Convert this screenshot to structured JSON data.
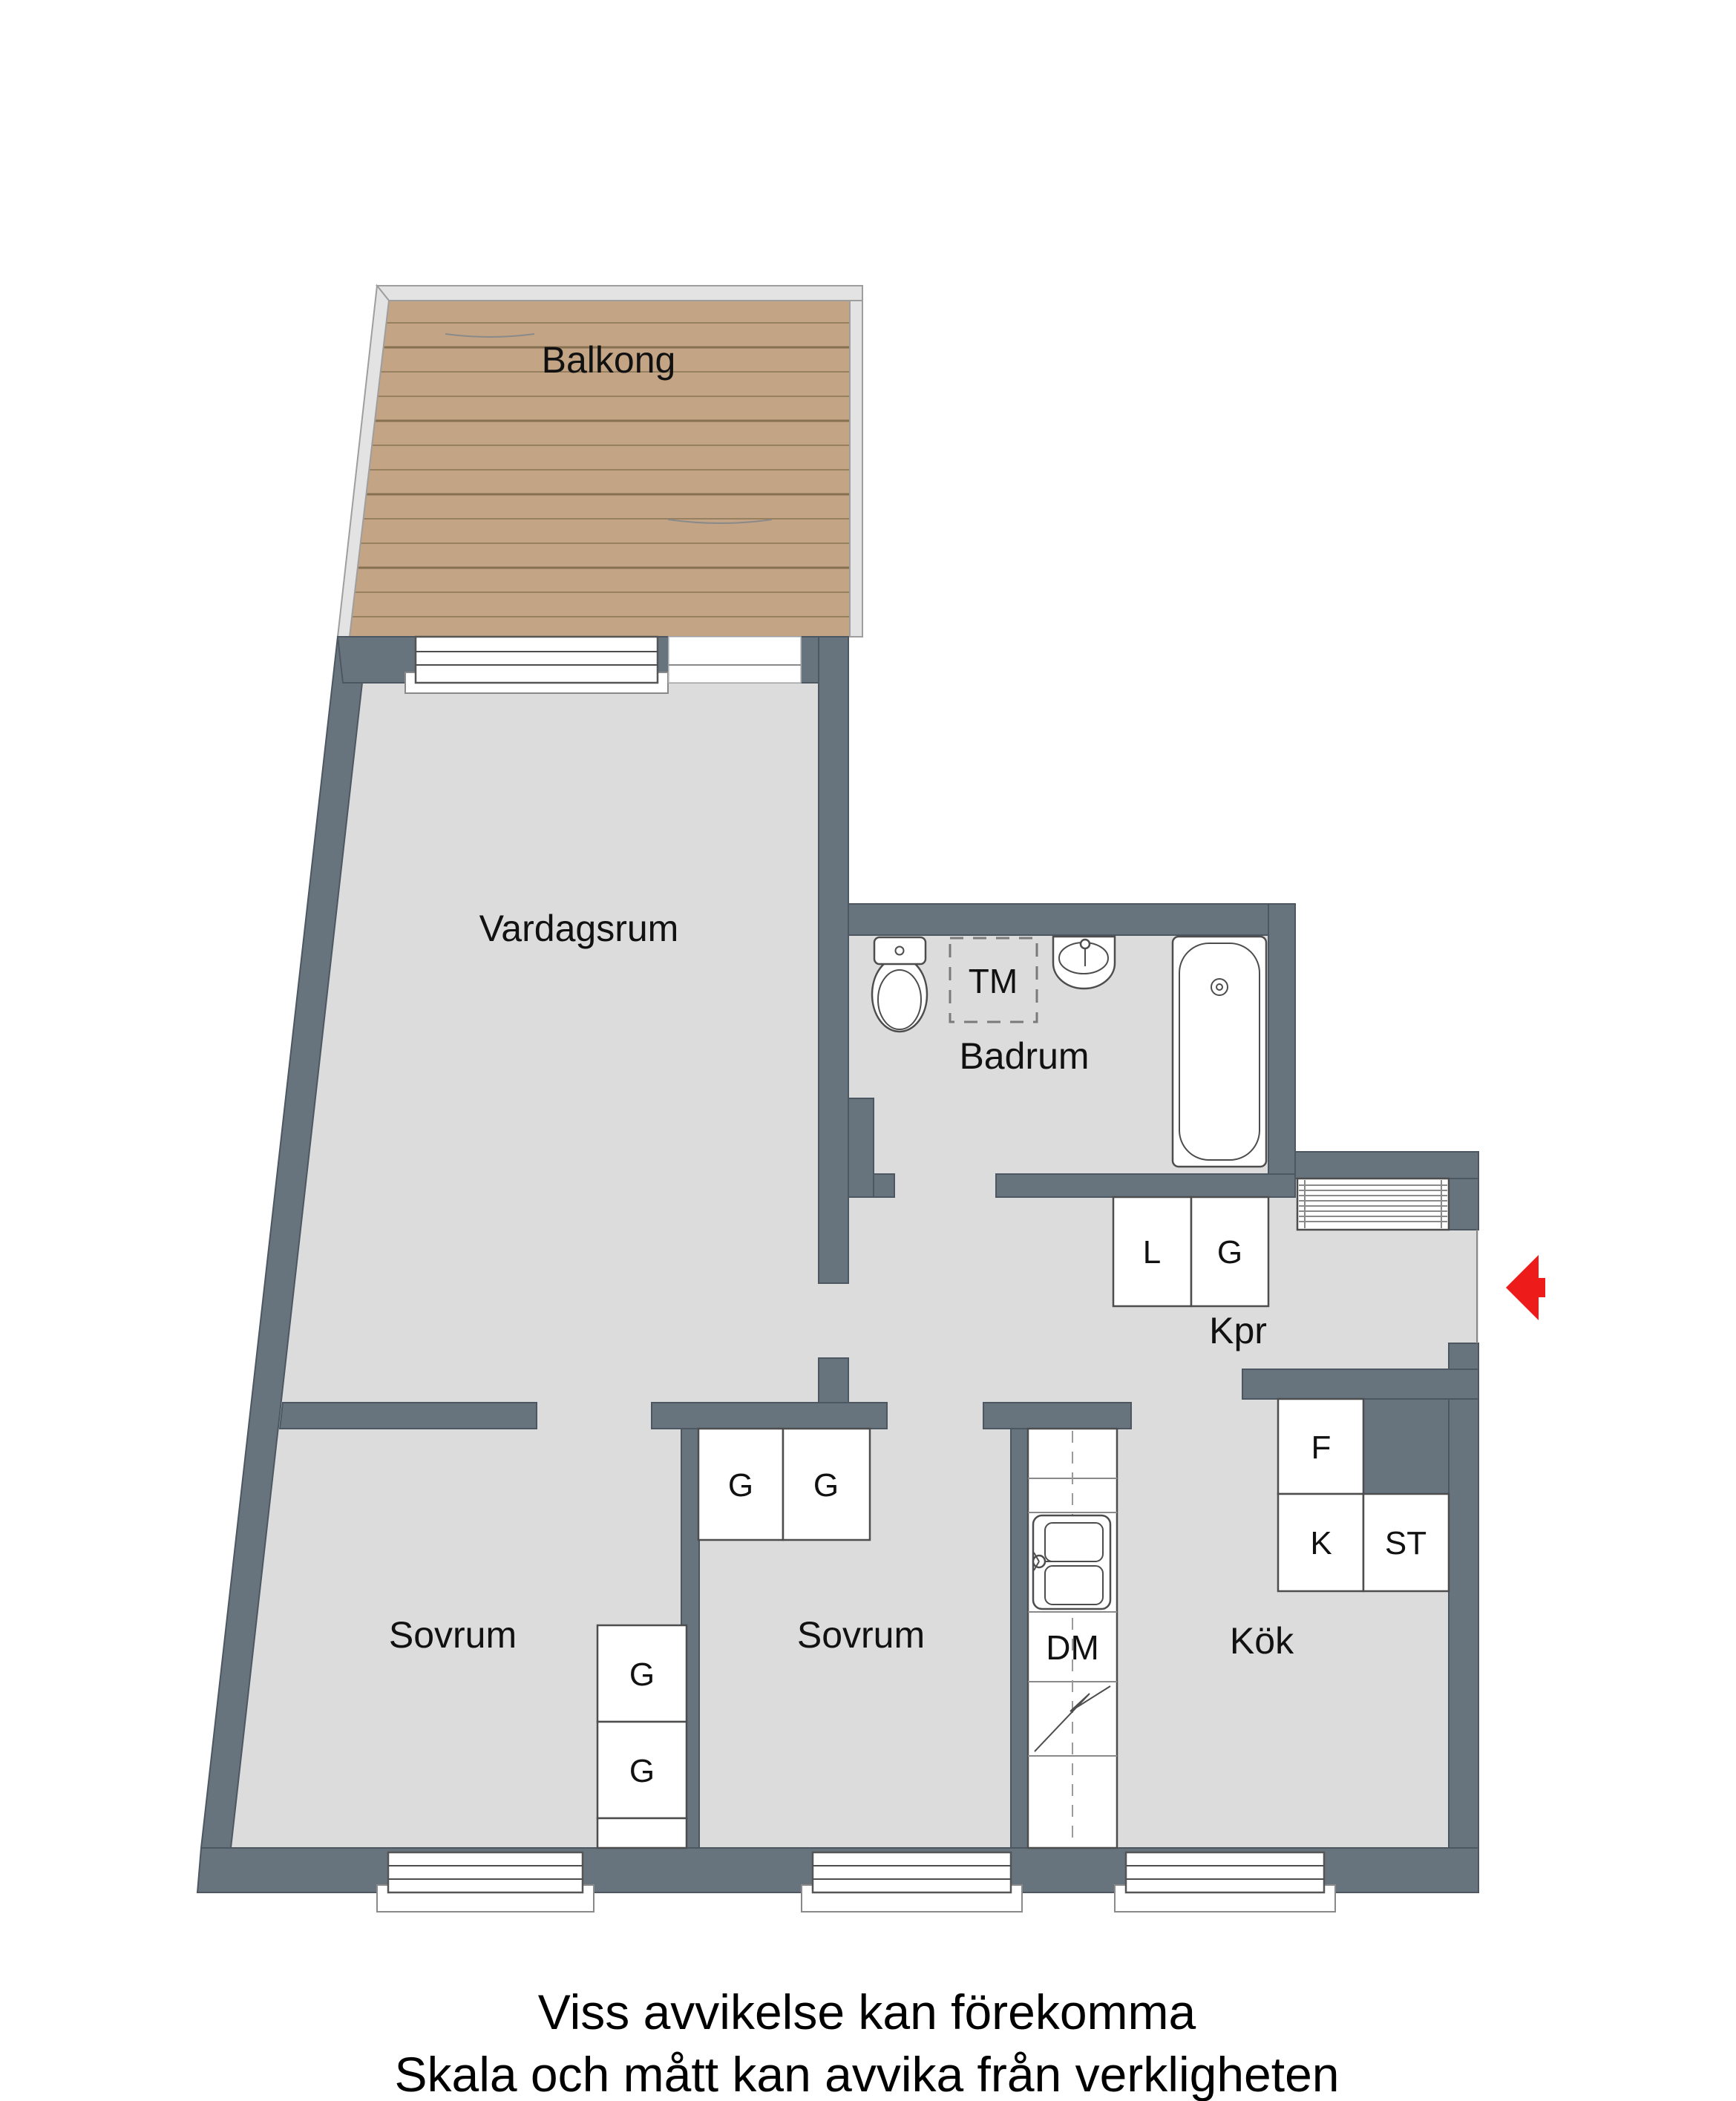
{
  "rooms": {
    "balcony": "Balkong",
    "living_room": "Vardagsrum",
    "bathroom": "Badrum",
    "hallway": "Kpr",
    "bedroom": "Sovrum",
    "kitchen": "Kök"
  },
  "fixtures": {
    "washing_machine": "TM",
    "dishwasher": "DM",
    "linen_closet": "L",
    "wardrobe": "G",
    "fridge": "F",
    "freezer": "K",
    "cleaning_closet": "ST"
  },
  "footer": {
    "disclaimer_line1": "Viss avvikelse kan förekomma",
    "disclaimer_line2": "Skala och mått kan avvika från verkligheten"
  },
  "colors": {
    "wall": "#67747e",
    "floor": "#dcdcdc",
    "balcony_deck": "#c3a585",
    "plank_line": "#96805f",
    "railing": "#e3e3e3",
    "entrance_arrow_red": "#ee1b1b",
    "text": "#111111",
    "background": "#ffffff"
  }
}
